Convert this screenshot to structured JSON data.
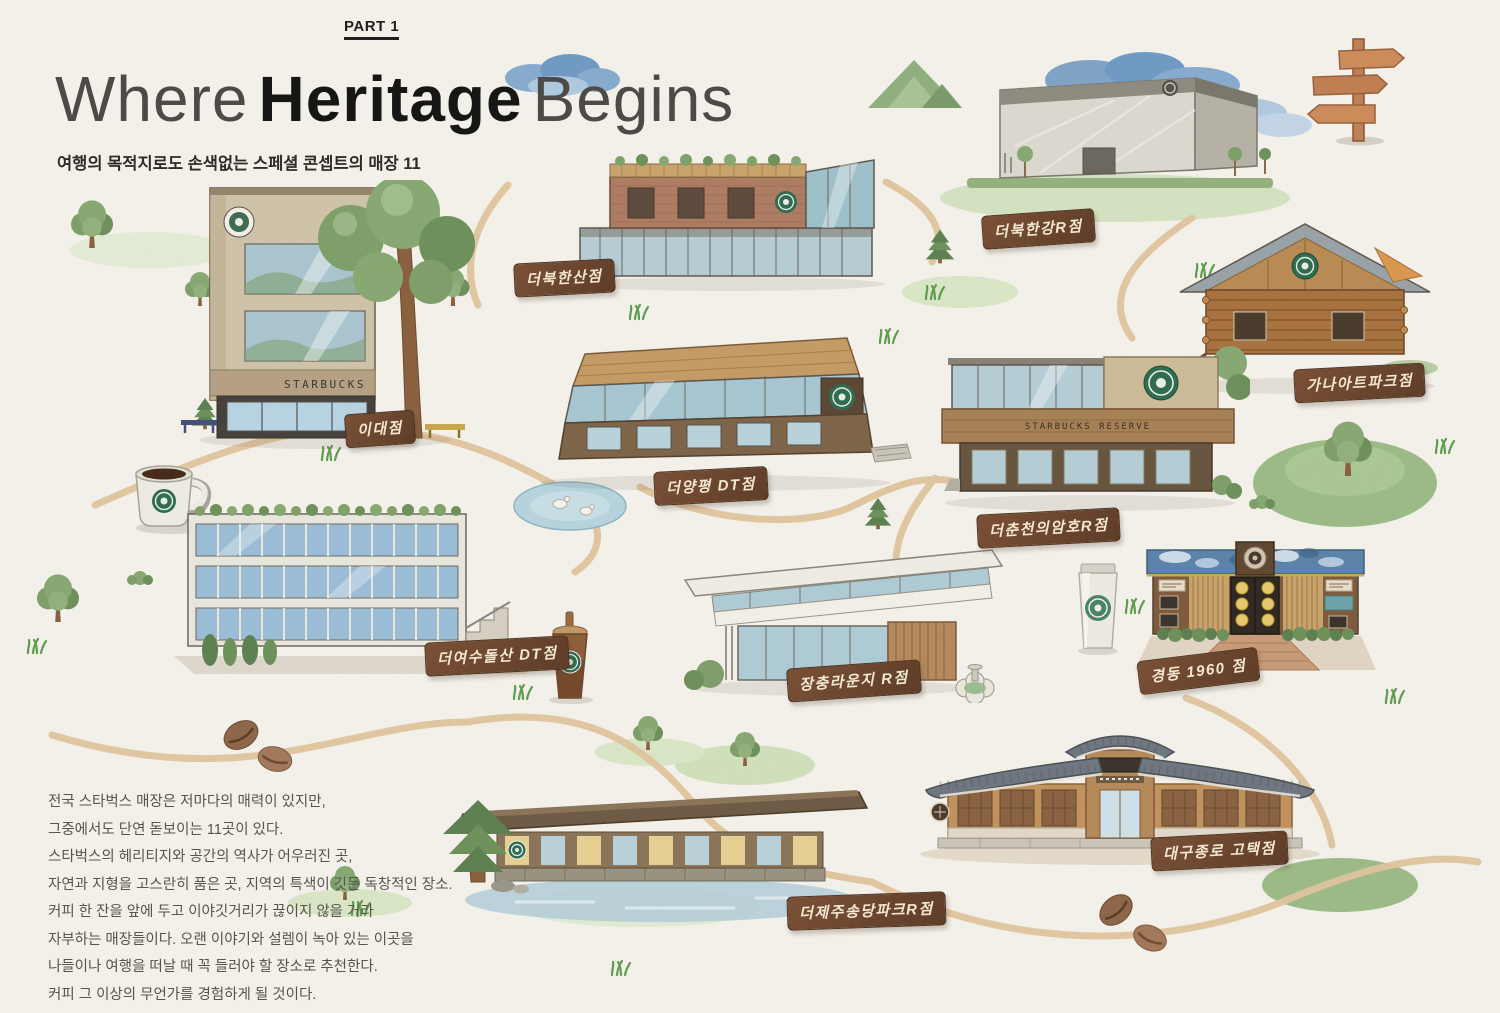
{
  "page": {
    "part_label": "PART 1",
    "title": {
      "light1": "Where",
      "bold": "Heritage",
      "light2": "Begins"
    },
    "subtitle": "여행의 목적지로도 손색없는 스페셜 콘셉트의 매장 11"
  },
  "intro": {
    "lines": [
      "전국 스타벅스 매장은 저마다의 매력이 있지만,",
      "그중에서도 단연 돋보이는 11곳이 있다.",
      "스타벅스의 헤리티지와 공간의 역사가 어우러진 곳,",
      "자연과 지형을 고스란히 품은 곳, 지역의 특색이 깃든 독창적인 장소.",
      "커피 한 잔을 앞에 두고 이야깃거리가 끊이지 않을 거라",
      "자부하는 매장들이다. 오랜 이야기와 설렘이 녹아 있는 이곳을",
      "나들이나 여행을 떠날 때 꼭 들러야 할 장소로 추천한다.",
      "커피 그 이상의 무언가를 경험하게 될 것이다."
    ]
  },
  "stores": [
    {
      "id": "ewha",
      "label": "이대점",
      "building_text": "STARBUCKS"
    },
    {
      "id": "bukhansan",
      "label": "더북한산점"
    },
    {
      "id": "bukhangang",
      "label": "더북한강R점"
    },
    {
      "id": "gana-art-park",
      "label": "가나아트파크점"
    },
    {
      "id": "yangpyeong",
      "label": "더양평 DT점"
    },
    {
      "id": "chuncheon",
      "label": "더춘천의암호R점",
      "building_text": "STARBUCKS RESERVE"
    },
    {
      "id": "yeosu-dolsan",
      "label": "더여수돌산 DT점"
    },
    {
      "id": "jangchung",
      "label": "장충라운지 R점"
    },
    {
      "id": "kyungdong-1960",
      "label": "경동 1960 점"
    },
    {
      "id": "jeju-songdang",
      "label": "더제주송당파크R점"
    },
    {
      "id": "daegu-jongro",
      "label": "대구종로 고택점"
    }
  ],
  "colors": {
    "paper": "#f3f1ea",
    "sign_brown": "#6d452e",
    "sign_text": "#f4e8d4",
    "path_tan": "#dfc49c",
    "title_dark": "#141412",
    "foliage_green": "#86a871",
    "cloud_blue": "#86abce",
    "siren_green": "#2f6b50"
  },
  "decorations": [
    "cloud-icon",
    "mountain-icon",
    "signpost-icon",
    "coffee-mug-icon",
    "iced-coffee-cup-icon",
    "tumbler-icon",
    "coffee-beans-icon",
    "pond-icon",
    "duck-icon",
    "tree-icon",
    "pine-tree-icon",
    "bush-icon",
    "grass-icon"
  ]
}
